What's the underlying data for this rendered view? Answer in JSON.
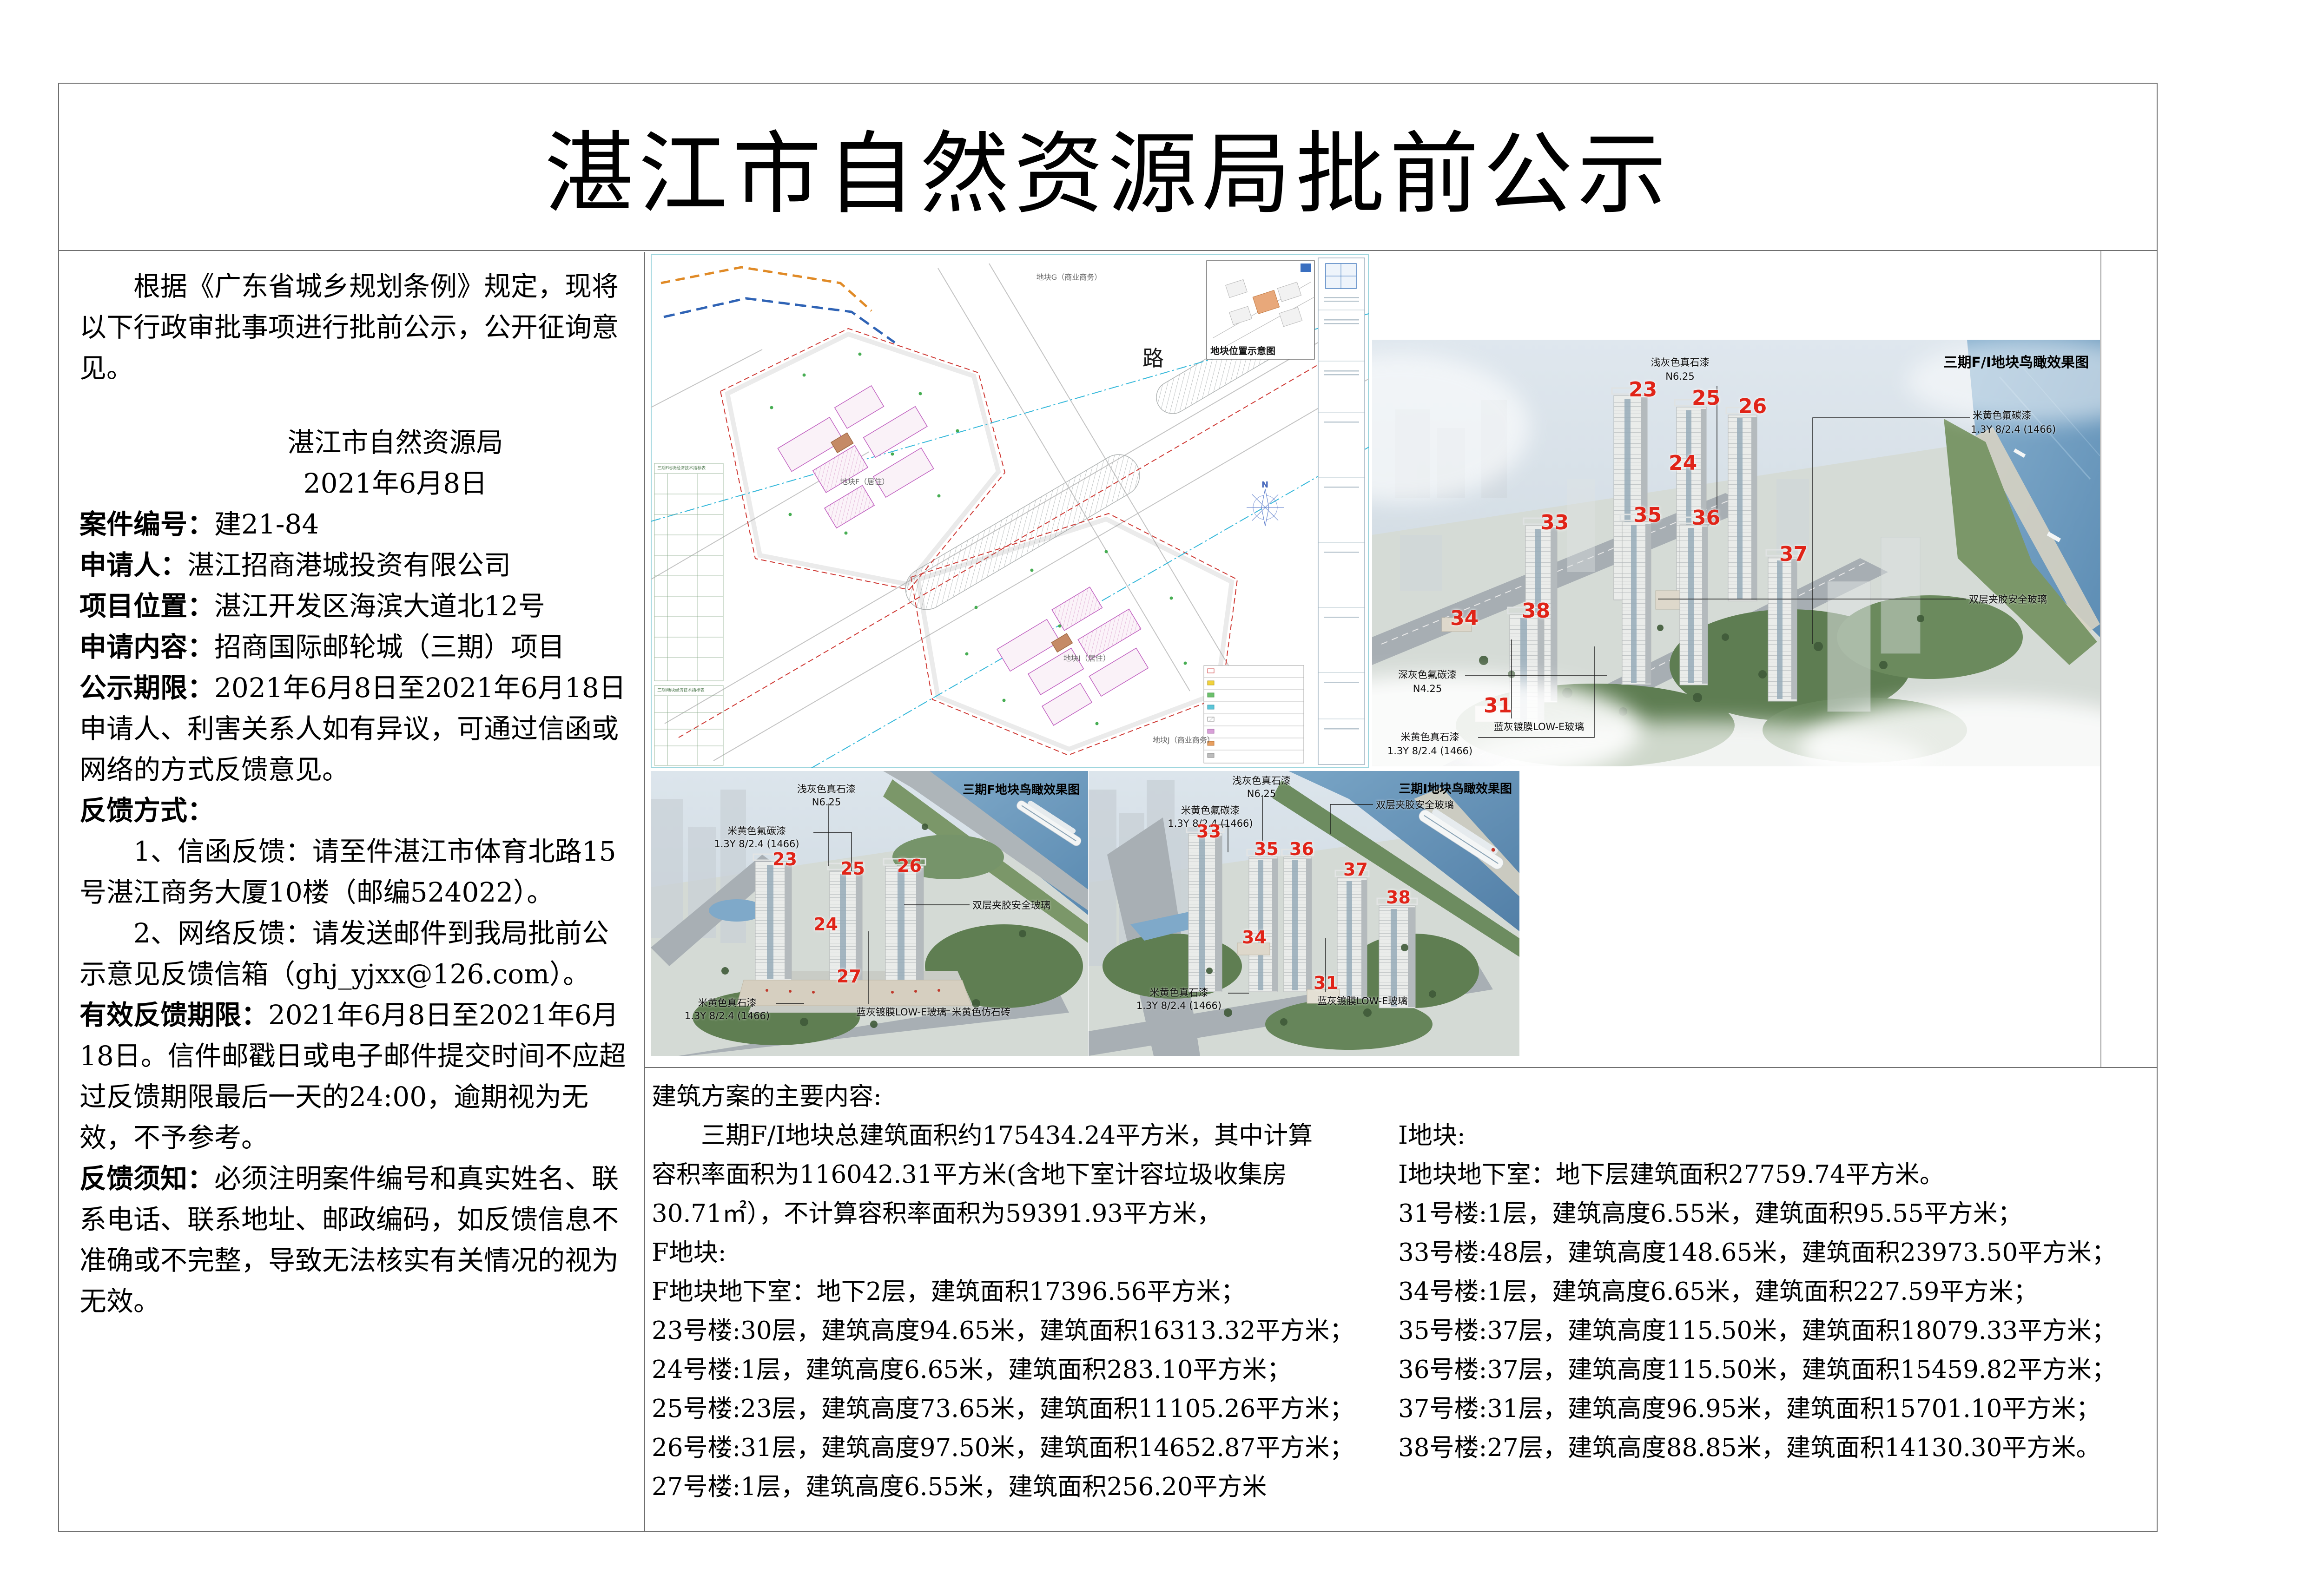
{
  "title": "湛江市自然资源局批前公示",
  "left_panel": {
    "intro": "　　根据《广东省城乡规划条例》规定，现将以下行政审批事项进行批前公示，公开征询意见。",
    "agency": "湛江市自然资源局",
    "date": "2021年6月8日",
    "case_label": "案件编号：",
    "case_value": "建21-84",
    "applicant_label": "申请人：",
    "applicant_value": "湛江招商港城投资有限公司",
    "location_label": "项目位置：",
    "location_value": "湛江开发区海滨大道北12号",
    "content_label": "申请内容：",
    "content_value": "招商国际邮轮城（三期）项目",
    "period_label": "公示期限：",
    "period_value": "2021年6月8日至2021年6月18日",
    "objection": "申请人、利害关系人如有异议，可通过信函或网络的方式反馈意见。",
    "feedback_label": "反馈方式：",
    "feedback_1": "　　1、信函反馈：请至件湛江市体育北路15号湛江商务大厦10楼（邮编524022）。",
    "feedback_2": "　　2、网络反馈：请发送邮件到我局批前公示意见反馈信箱（ghj_yjxx@126.com）。",
    "valid_label": "有效反馈期限：",
    "valid_text": "2021年6月8日至2021年6月18日。信件邮戳日或电子邮件提交时间不应超过反馈期限最后一天的24:00，逾期视为无效，不予参考。",
    "note_label": "反馈须知：",
    "note_text": "必须注明案件编号和真实姓名、联系电话、联系地址、邮政编码，如反馈信息不准确或不完整，导致无法核实有关情况的视为无效。"
  },
  "site_plan": {
    "road_label": "路",
    "parcel_g_label": "地块G（商业商务）",
    "parcel_f_label": "地块F（居住）",
    "parcel_i_label": "地块I（居住）",
    "parcel_j_label": "地块J（商业商务）",
    "inset_title": "地块位置示意图",
    "table_f_title": "三期F地块经济技术指标表",
    "table_i_title": "三期I地块经济技术指标表",
    "north_label": "N"
  },
  "render_big": {
    "title": "三期F/I地块鸟瞰效果图",
    "numbers": [
      "23",
      "25",
      "26",
      "24",
      "33",
      "35",
      "36",
      "37",
      "34",
      "38",
      "31"
    ],
    "ann": {
      "light_gray_stone": [
        "浅灰色真石漆",
        "N6.25"
      ],
      "beige_fluoro": [
        "米黄色氟碳漆",
        "1.3Y 8/2.4 (1466)"
      ],
      "laminated_glass": [
        "双层夹胶安全玻璃"
      ],
      "dark_gray_fluoro": [
        "深灰色氟碳漆",
        "N4.25"
      ],
      "beige_stone": [
        "米黄色真石漆",
        "1.3Y 8/2.4 (1466)"
      ],
      "lowe_glass": [
        "蓝灰镀膜LOW-E玻璃"
      ]
    }
  },
  "render_f": {
    "title": "三期F地块鸟瞰效果图",
    "numbers": [
      "23",
      "25",
      "26",
      "24",
      "27"
    ],
    "ann": {
      "light_gray_stone": [
        "浅灰色真石漆",
        "N6.25"
      ],
      "beige_fluoro": [
        "米黄色氟碳漆",
        "1.3Y 8/2.4 (1466)"
      ],
      "laminated_glass": [
        "双层夹胶安全玻璃"
      ],
      "beige_stone": [
        "米黄色真石漆",
        "1.3Y 8/2.4 (1466)"
      ],
      "lowe_glass": [
        "蓝灰镀膜LOW-E玻璃"
      ],
      "beige_brick": [
        "米黄色仿石砖"
      ]
    }
  },
  "render_i": {
    "title": "三期I地块鸟瞰效果图",
    "numbers": [
      "33",
      "35",
      "36",
      "37",
      "38",
      "34",
      "31"
    ],
    "ann": {
      "light_gray_stone": [
        "浅灰色真石漆",
        "N6.25"
      ],
      "beige_fluoro": [
        "米黄色氟碳漆",
        "1.3Y 8/2.4 (1466)"
      ],
      "laminated_glass": [
        "双层夹胶安全玻璃"
      ],
      "beige_stone": [
        "米黄色真石漆",
        "1.3Y 8/2.4 (1466)"
      ],
      "lowe_glass": [
        "蓝灰镀膜LOW-E玻璃"
      ]
    }
  },
  "building_scheme": {
    "heading": "建筑方案的主要内容:",
    "left_lines": [
      "　　三期F/I地块总建筑面积约175434.24平方米，其中计算",
      "容积率面积为116042.31平方米(含地下室计容垃圾收集房",
      "30.71㎡），不计算容积率面积为59391.93平方米，",
      "F地块:",
      "F地块地下室：地下2层，建筑面积17396.56平方米；",
      "23号楼:30层，建筑高度94.65米，建筑面积16313.32平方米；",
      "24号楼:1层，建筑高度6.65米，建筑面积283.10平方米；",
      "25号楼:23层，建筑高度73.65米，建筑面积11105.26平方米；",
      "26号楼:31层，建筑高度97.50米，建筑面积14652.87平方米；",
      "27号楼:1层，建筑高度6.55米，建筑面积256.20平方米"
    ],
    "right_lines": [
      "I地块:",
      "I地块地下室：地下层建筑面积27759.74平方米。",
      "31号楼:1层，建筑高度6.55米，建筑面积95.55平方米；",
      "33号楼:48层，建筑高度148.65米，建筑面积23973.50平方米；",
      "34号楼:1层，建筑高度6.65米，建筑面积227.59平方米；",
      "35号楼:37层，建筑高度115.50米，建筑面积18079.33平方米；",
      "36号楼:37层，建筑高度115.50米，建筑面积15459.82平方米；",
      "37号楼:31层，建筑高度96.95米，建筑面积15701.10平方米；",
      "38号楼:27层，建筑高度88.85米，建筑面积14130.30平方米。"
    ]
  }
}
